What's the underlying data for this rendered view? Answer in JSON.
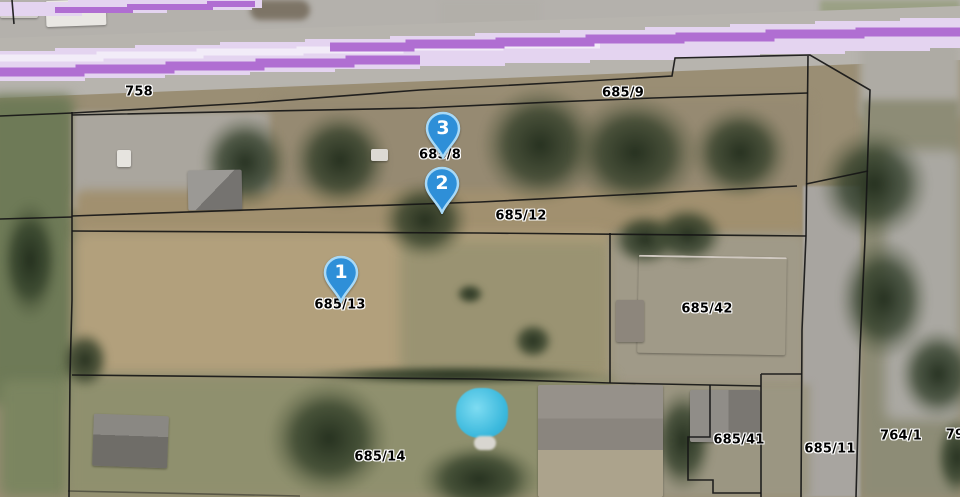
{
  "map": {
    "view": "satellite-cadastral",
    "markers": [
      {
        "number": "1"
      },
      {
        "number": "2"
      },
      {
        "number": "3"
      }
    ],
    "labels": [
      {
        "text": "758"
      },
      {
        "text": "685/9"
      },
      {
        "text": "685/8"
      },
      {
        "text": "685/12"
      },
      {
        "text": "685/13"
      },
      {
        "text": "685/42"
      },
      {
        "text": "685/14"
      },
      {
        "text": "685/41"
      },
      {
        "text": "685/11"
      },
      {
        "text": "764/1"
      },
      {
        "text": "79"
      }
    ],
    "colors": {
      "marker_fill": "#2e8fd8",
      "marker_ring": "#a8d9f7",
      "marker_number": "#ffffff",
      "parcel_line": "#161616",
      "label_text": "#000000",
      "label_halo": "#ffffff",
      "route_band": "#e4d4f0",
      "route_pale": "#f2ecf8",
      "route_stripe": "#b06ed2"
    }
  }
}
